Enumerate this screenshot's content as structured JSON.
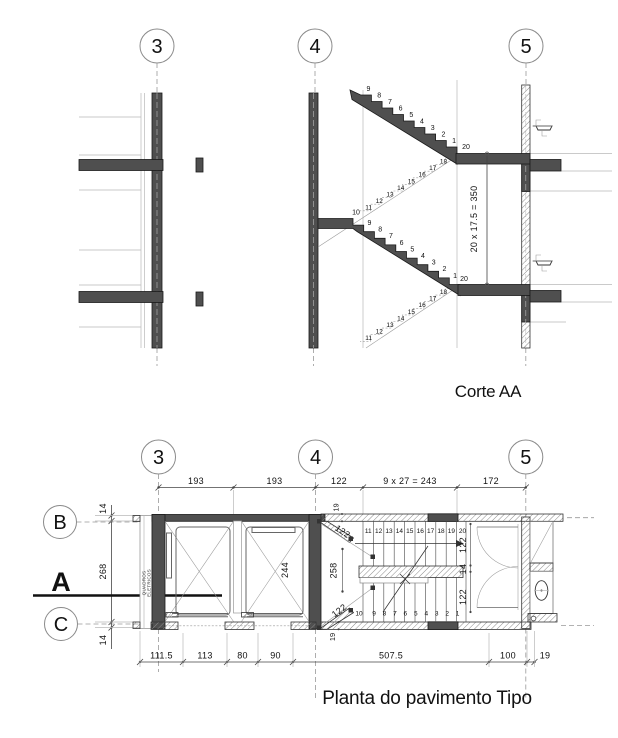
{
  "grid_labels": [
    "3",
    "4",
    "5"
  ],
  "row_labels": [
    "B",
    "C"
  ],
  "section_cut_label": "A",
  "section": {
    "title": "Corte AA",
    "stair_dim": "20 x 17.5 = 350",
    "upper_flight": [
      "9",
      "8",
      "7",
      "6",
      "5",
      "4",
      "3",
      "2",
      "1"
    ],
    "upper_flight_end": "20",
    "lower_flight_start": "10",
    "lower_flight": [
      "9",
      "8",
      "7",
      "6",
      "5",
      "4",
      "3",
      "2",
      "1"
    ],
    "lower_flight_end": "20",
    "hidden_upper": [
      "18",
      "17",
      "16",
      "15",
      "14",
      "13",
      "12",
      "11"
    ],
    "hidden_lower": [
      "18",
      "17",
      "16",
      "15",
      "14",
      "13",
      "12",
      "11"
    ]
  },
  "plan": {
    "title": "Planta do pavimento Tipo",
    "dims_top": [
      "193",
      "193",
      "122",
      "9 x 27 = 243",
      "172"
    ],
    "dims_bottom": [
      "111.5",
      "113",
      "80",
      "90",
      "507.5",
      "100",
      "19"
    ],
    "dims_left": [
      "14",
      "268",
      "14"
    ],
    "dims_right": [
      "122",
      "14",
      "122"
    ],
    "landing_dims": [
      "122",
      "258",
      "122"
    ],
    "wall_dim_top": "19",
    "wall_dim_bottom": "19",
    "shaft_dim": "244",
    "electrical_label_1": "QUADROS",
    "electrical_label_2": "ELETRICOS",
    "treads_top_run": [
      "11",
      "12",
      "13",
      "14",
      "15",
      "16",
      "17",
      "18",
      "19"
    ],
    "tread_top_last": "20",
    "tread_bottom_first": "10",
    "treads_bottom_run": [
      "9",
      "8",
      "7",
      "6",
      "5",
      "4",
      "3",
      "2",
      "1"
    ]
  },
  "colors": {
    "wall_fill": "#4f4f4f",
    "hatch_line": "#8a8a8a",
    "light_line": "#b8b8b8",
    "text": "#111111"
  }
}
